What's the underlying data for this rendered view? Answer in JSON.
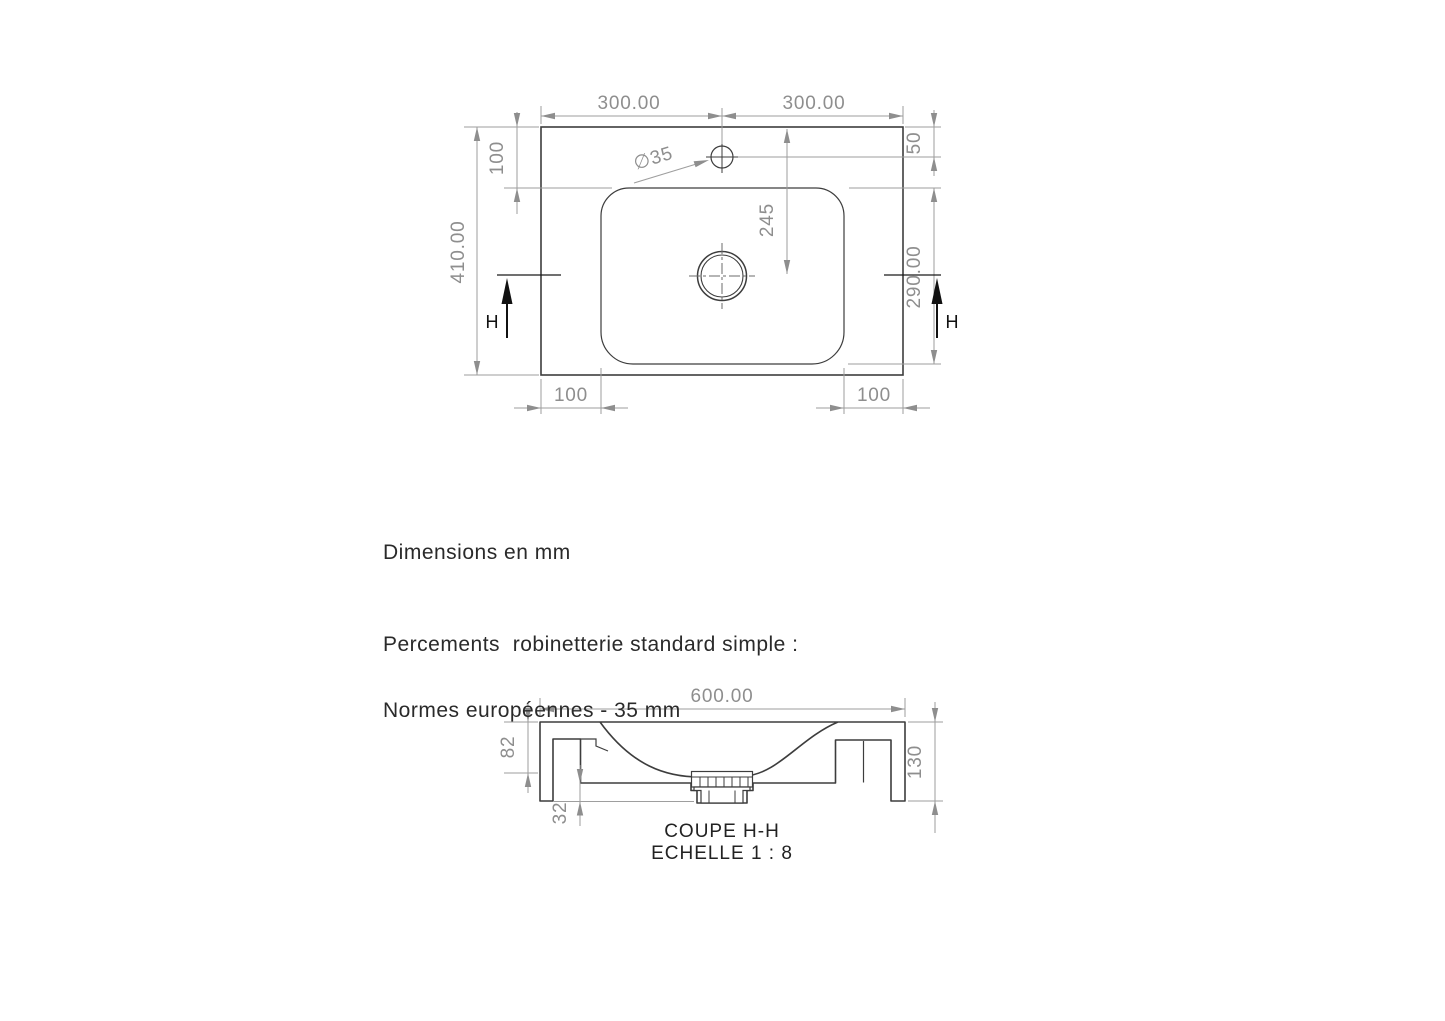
{
  "document": {
    "units_note": "Dimensions en mm",
    "drilling_note_line1": "Percements  robinetterie standard simple :",
    "drilling_note_line2": "Normes européennes - 35 mm"
  },
  "top_view": {
    "dim_left_to_faucet": "300.00",
    "dim_faucet_to_right": "300.00",
    "dim_top_to_basin": "100",
    "dim_overall_depth": "410.00",
    "dim_top_to_faucet": "50",
    "dim_top_to_drain": "245",
    "dim_basin_depth": "290.00",
    "dim_bottom_left_margin": "100",
    "dim_bottom_right_margin": "100",
    "faucet_hole_label": "∅35",
    "section_label_left": "H",
    "section_label_right": "H"
  },
  "section_view": {
    "dim_overall_width": "600.00",
    "dim_top_thickness": "82",
    "dim_skirt_height": "32",
    "dim_overall_height": "130",
    "title": "COUPE H-H",
    "scale_label": "ECHELLE 1 : 8"
  },
  "colors": {
    "background": "#ffffff",
    "drawing_line": "#3d3d3d",
    "dimension_gray": "#8e8e8e",
    "section_marker_black": "#111111"
  }
}
